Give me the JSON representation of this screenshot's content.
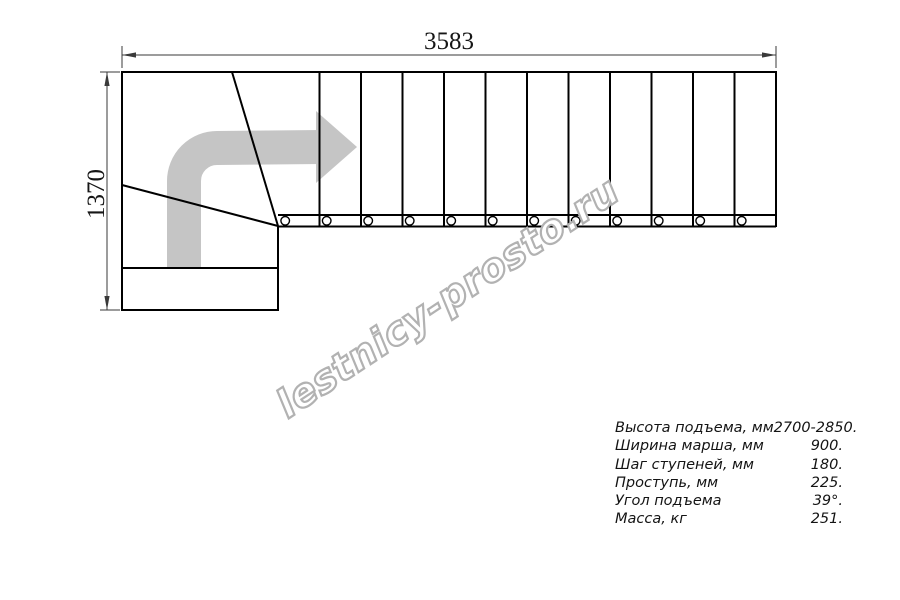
{
  "drawing": {
    "width_mm": "3583",
    "height_mm": "1370",
    "watermark": "lestnicy-prosto.ru",
    "treads": 12,
    "balusters": 12,
    "colors": {
      "plan_line": "#000000",
      "arrow": "#c5c5c5",
      "watermark_outline": "#b2b2b2",
      "dimension": "#3a3a3a"
    }
  },
  "specs": {
    "rows": [
      {
        "label": "Высота подъема, мм",
        "value": "2700-2850."
      },
      {
        "label": "Ширина марша, мм",
        "value": "900."
      },
      {
        "label": "Шаг ступеней, мм",
        "value": "180."
      },
      {
        "label": "Проступь, мм",
        "value": "225."
      },
      {
        "label": "Угол подъема",
        "value": "39°."
      },
      {
        "label": "Масса, кг",
        "value": "251."
      }
    ]
  }
}
